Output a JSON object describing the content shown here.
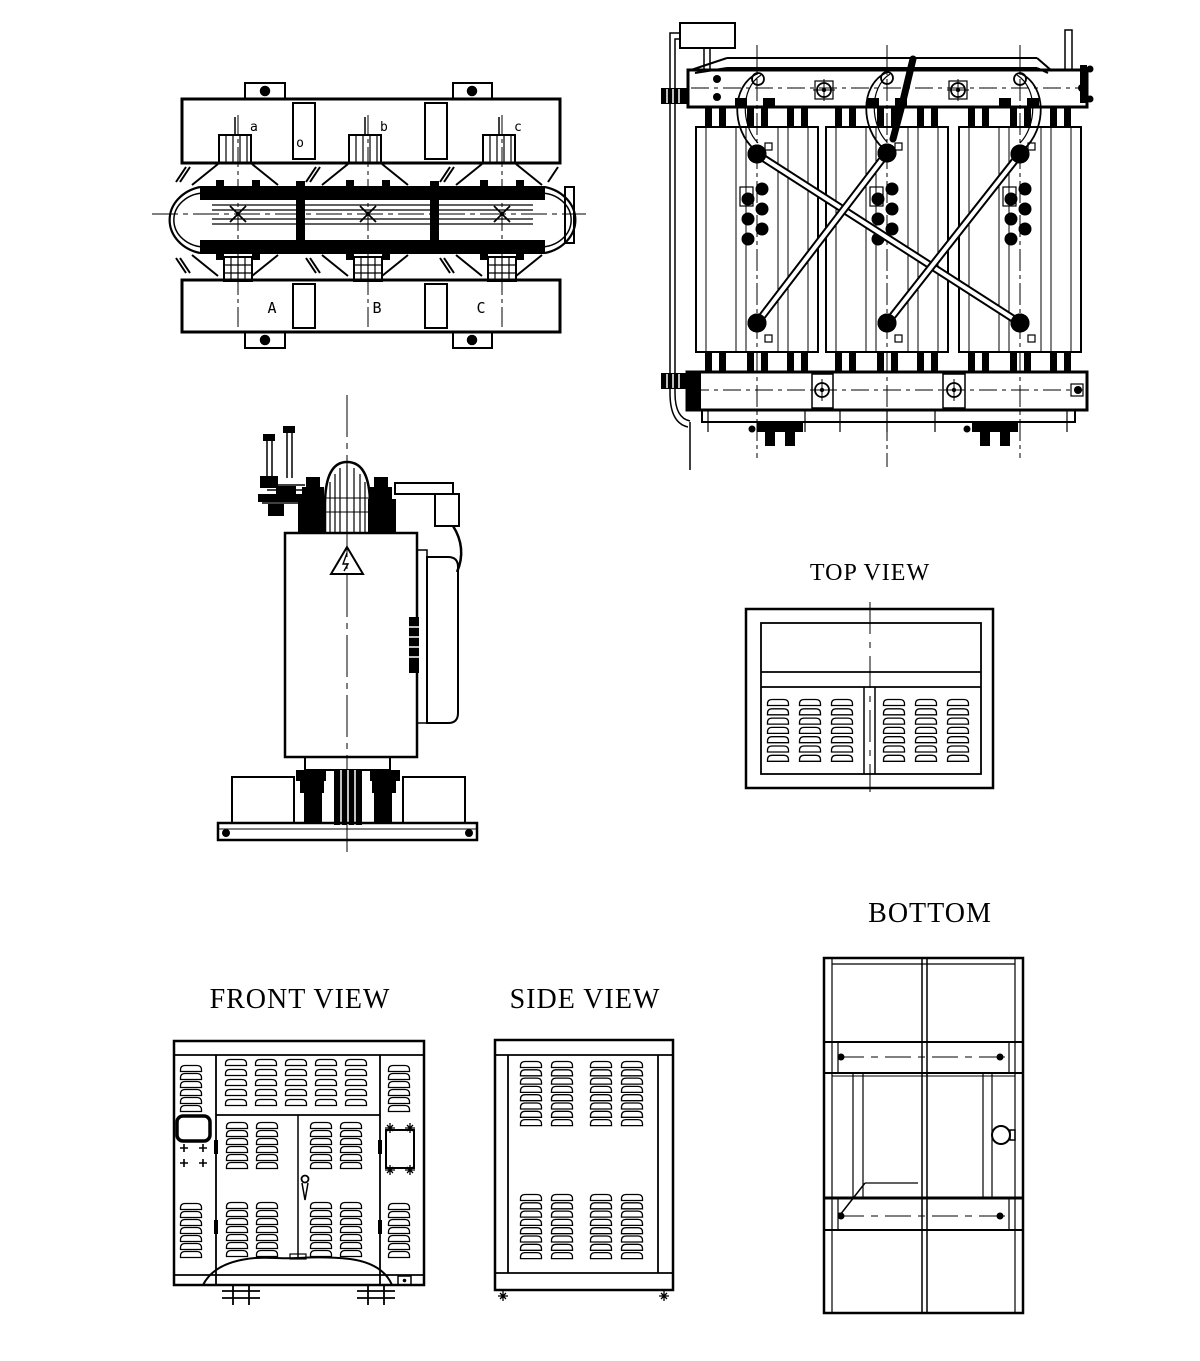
{
  "canvas": {
    "width": 1200,
    "height": 1361,
    "background": "#ffffff",
    "ink": "#000000"
  },
  "titles": {
    "top_view": "TOP VIEW",
    "bottom": "BOTTOM",
    "front_view": "FRONT VIEW",
    "side_view": "SIDE VIEW"
  },
  "plan_labels": {
    "phase_top": [
      "a",
      "b",
      "c"
    ],
    "neutral": "o",
    "phase_bottom": [
      "A",
      "B",
      "C"
    ]
  }
}
